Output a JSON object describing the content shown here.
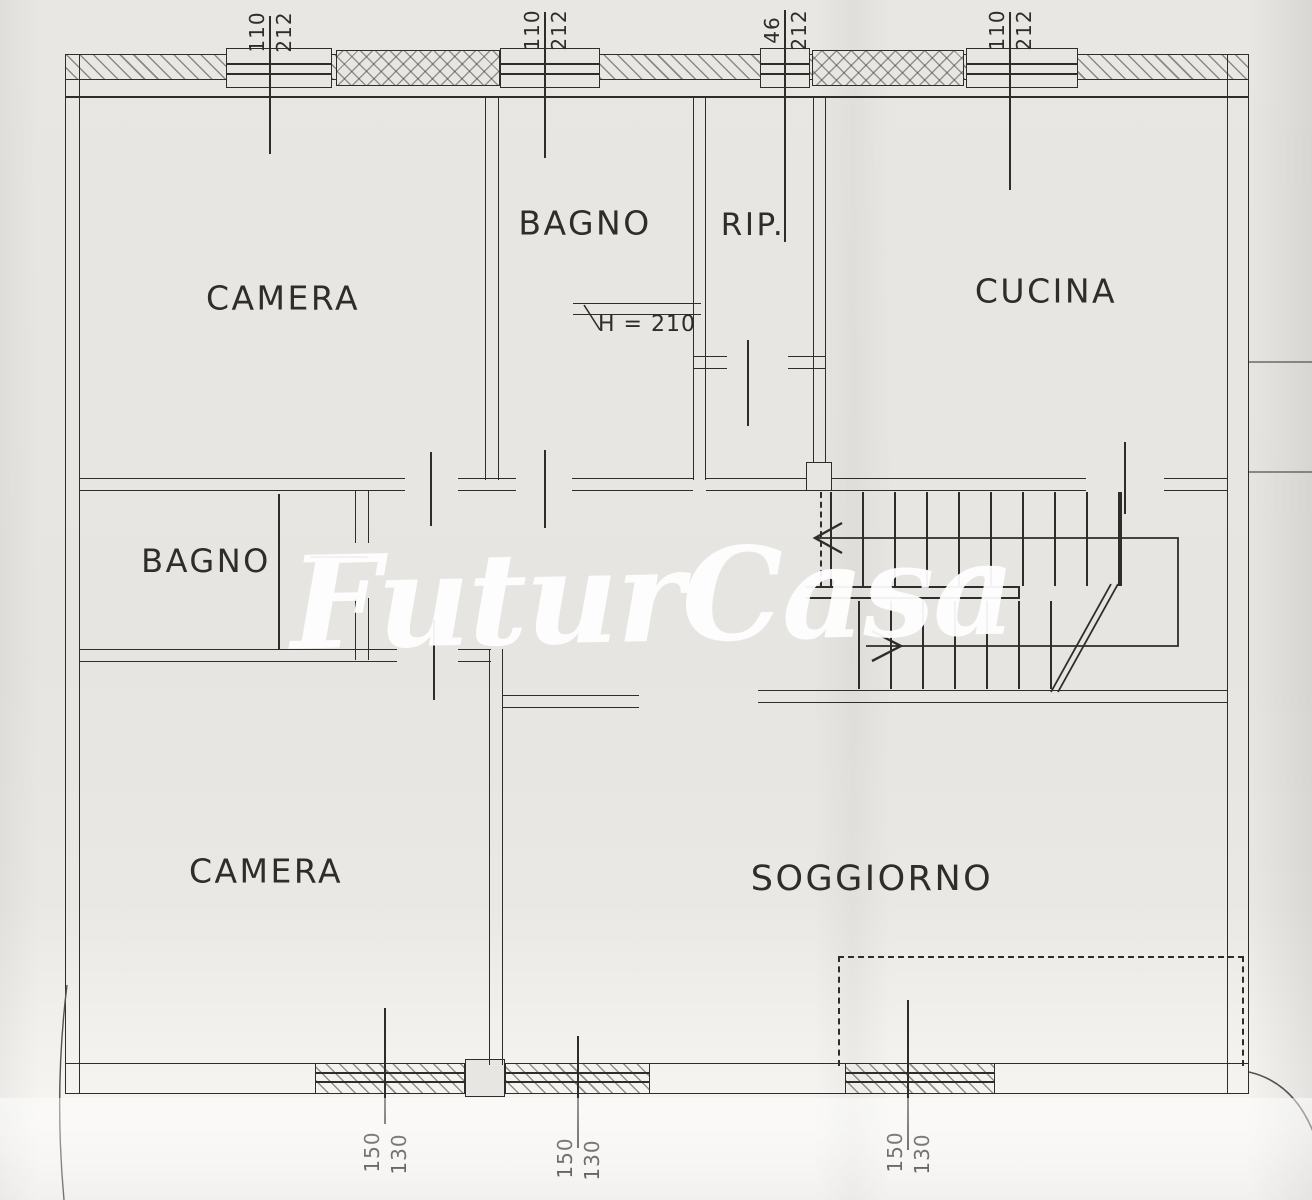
{
  "watermark_text": "FuturCasa",
  "rooms": {
    "camera_top": "CAMERA",
    "bagno_top": "BAGNO",
    "rip": "RIP.",
    "cucina": "CUCINA",
    "bagno_mid": "BAGNO",
    "camera_bottom": "CAMERA",
    "soggiorno": "SOGGIORNO"
  },
  "annotation": {
    "ceiling_height": "H = 210"
  },
  "dims_top": [
    {
      "a": "110",
      "b": "212"
    },
    {
      "a": "110",
      "b": "212"
    },
    {
      "a": "46",
      "b": "212"
    },
    {
      "a": "110",
      "b": "212"
    }
  ],
  "dims_bottom": [
    {
      "a": "150",
      "b": "130"
    },
    {
      "a": "150",
      "b": "130"
    },
    {
      "a": "150",
      "b": "130"
    }
  ],
  "colors": {
    "paper": "#e8e6e2",
    "ink": "#2e2d2b",
    "watermark": "#ffffff"
  }
}
